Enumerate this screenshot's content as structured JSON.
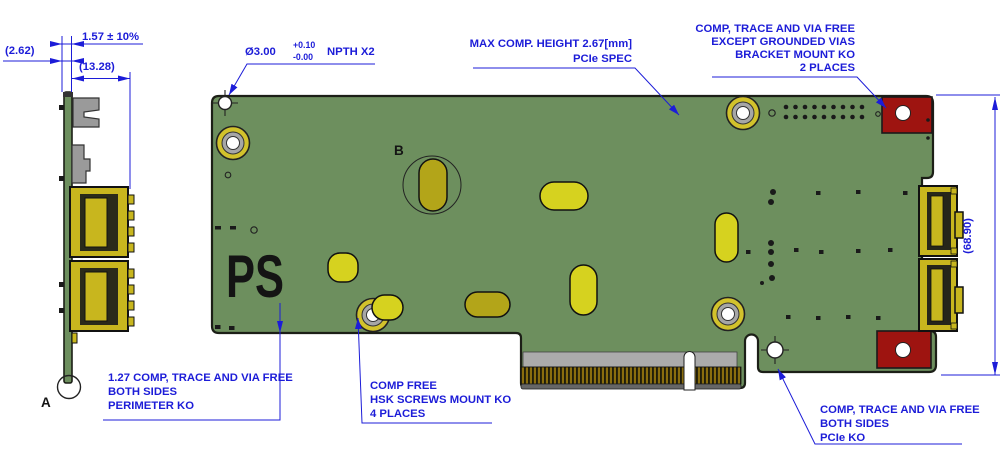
{
  "drawing": {
    "labels": {
      "ps": "PS",
      "detail_a": "A",
      "detail_b": "B"
    },
    "dimensions": {
      "pcb_thickness": "1.57 ± 10%",
      "bracket_offset": "(2.62)",
      "connector_depth": "(13.28)",
      "board_height": "(68.90)"
    },
    "npth_note": {
      "dia": "Ø3.00",
      "tol_plus": "+0.10",
      "tol_minus": "-0.00",
      "suffix": "NPTH X2"
    },
    "annotations": {
      "max_comp": {
        "lines": [
          "MAX COMP. HEIGHT 2.67[mm]",
          "PCIe SPEC"
        ]
      },
      "bracket_ko": {
        "lines": [
          "COMP, TRACE AND VIA FREE",
          "EXCEPT GROUNDED VIAS",
          "BRACKET MOUNT KO",
          "2 PLACES"
        ]
      },
      "perimeter_ko": {
        "lines": [
          "1.27 COMP, TRACE AND VIA FREE",
          "BOTH SIDES",
          "PERIMETER KO"
        ]
      },
      "hsk_ko": {
        "lines": [
          "COMP FREE",
          "HSK SCREWS MOUNT KO",
          "4 PLACES"
        ]
      },
      "pcie_ko": {
        "lines": [
          "COMP, TRACE AND VIA FREE",
          "BOTH SIDES",
          "PCIe KO"
        ]
      }
    },
    "colors": {
      "board_green": "#6d8f5e",
      "annotation_blue": "#1c1cd8",
      "keepout_red": "#9e1410",
      "pad_yellow": "#d6d21f",
      "pad_olive": "#b3a519",
      "ring_yellow": "#d2c22c",
      "gold_finger": "#8a6d0e"
    }
  }
}
